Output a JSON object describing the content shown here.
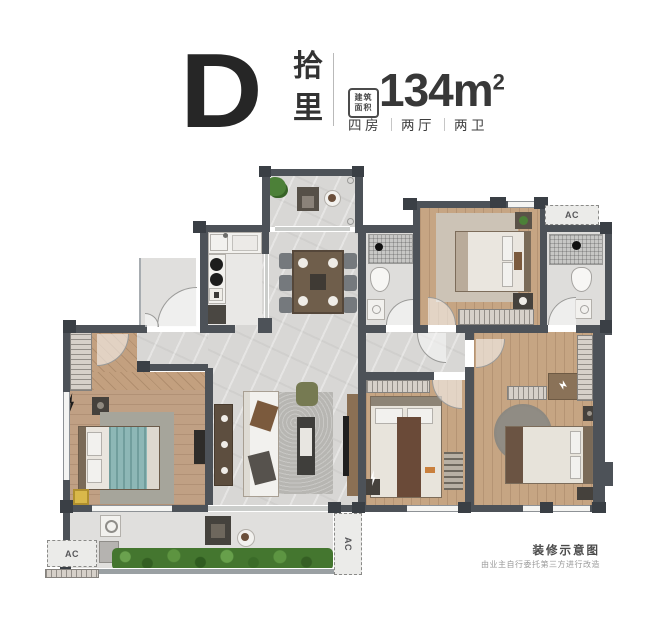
{
  "header": {
    "unit_letter": "D",
    "unit_name_chars": [
      "拾",
      "里"
    ],
    "area_badge_lines": [
      "建筑",
      "面积"
    ],
    "area_value": "134m",
    "area_exponent": "2",
    "specs": [
      "四房",
      "两厅",
      "两卫"
    ]
  },
  "plan": {
    "ac_label": "AC",
    "caption_title": "装修示意图",
    "caption_note": "由业主自行委托第三方进行改造"
  },
  "colors": {
    "wall": "#4d5258",
    "pier": "#3a3f45",
    "tile_floor": "#d8d7d5",
    "wood_floor": "#c6a583",
    "teal_bedding": "#8db7b6",
    "hedge_green": "#44762f",
    "yellow_stool": "#d9b84a",
    "title_text": "#262626",
    "caption_text": "#4a4a4a",
    "note_text": "#9b9b9b"
  }
}
